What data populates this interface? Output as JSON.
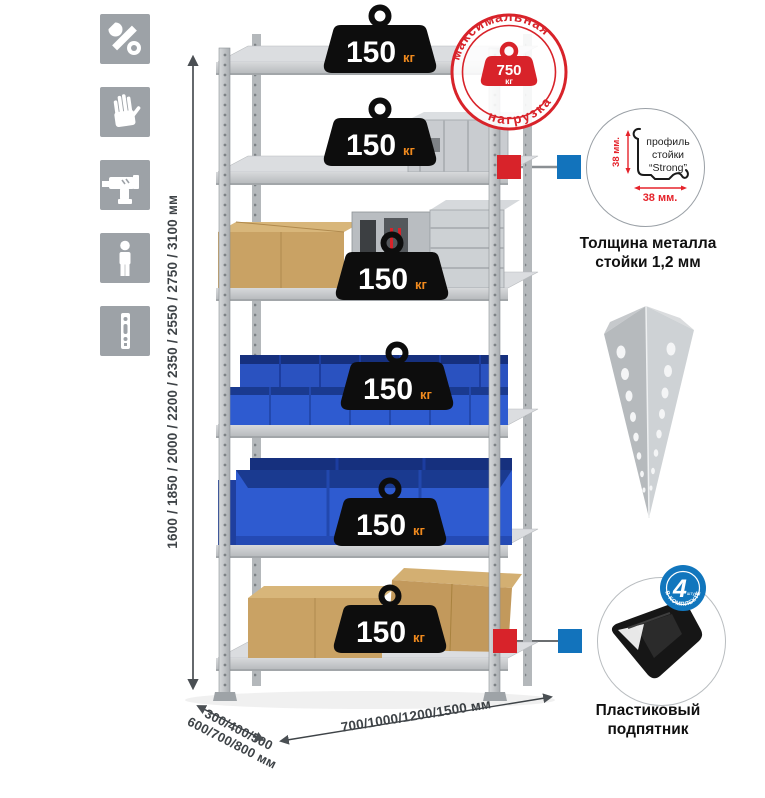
{
  "left_icons": [
    {
      "name": "wrench"
    },
    {
      "name": "gloves"
    },
    {
      "name": "drill"
    },
    {
      "name": "person"
    },
    {
      "name": "rack-post"
    }
  ],
  "dimensions": {
    "height": "1600 / 1850 / 2000 / 2200 / 2350 / 2550 / 2750 / 3100 мм",
    "depth": "300/400/500\n600/700/800 мм",
    "width": "700/1000/1200/1500 мм"
  },
  "max_load_stamp": {
    "arc_top": "максимальная",
    "arc_bottom": "нагрузка",
    "value": "750",
    "unit": "кг"
  },
  "shelf_loads": {
    "values": [
      "150",
      "150",
      "150",
      "150",
      "150",
      "150"
    ],
    "unit": "кг"
  },
  "profile_detail": {
    "line1": "профиль",
    "line2": "стойки",
    "line3": "“Strong”",
    "dim_vertical": "38 мм.",
    "dim_horizontal": "38 мм.",
    "caption": "Толщина металла\nстойки 1,2 мм"
  },
  "foot_detail": {
    "badge_value": "4",
    "badge_sub": "штуки",
    "badge_arc": "в комплекте",
    "caption": "Пластиковый\nподпятник"
  },
  "colors": {
    "accent_red": "#d8232a",
    "accent_blue": "#1273bc",
    "metal_gray": "#c7cacc",
    "bin_blue": "#2e5bd0",
    "box_tan": "#c9a264",
    "icon_gray": "#9da2a7",
    "weight_black": "#0d0d0d",
    "weight_unit_orange": "#f08a1e"
  }
}
